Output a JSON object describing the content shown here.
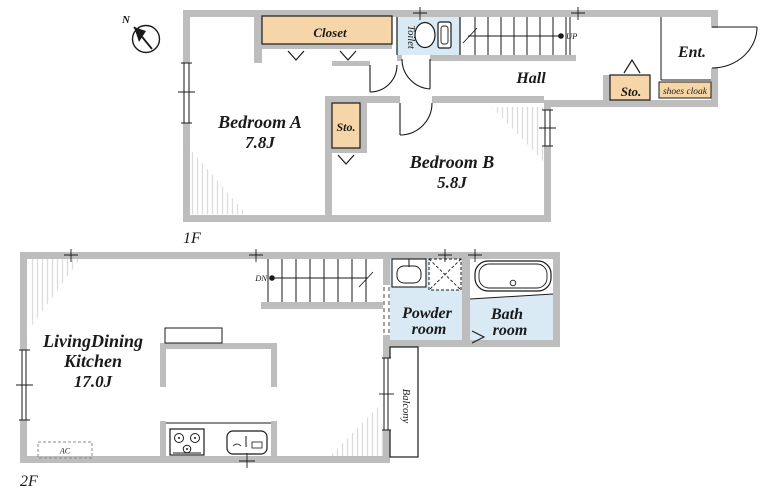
{
  "compass": {
    "north_label": "N"
  },
  "floor1": {
    "label": "1F",
    "bedroom_a": {
      "name": "Bedroom A",
      "size": "7.8J"
    },
    "bedroom_b": {
      "name": "Bedroom B",
      "size": "5.8J"
    },
    "closet": {
      "name": "Closet"
    },
    "toilet": {
      "name": "Toilet"
    },
    "hall": {
      "name": "Hall"
    },
    "entrance": {
      "name": "Ent."
    },
    "storage_hall": {
      "name": "Sto."
    },
    "storage_bedroom": {
      "name": "Sto."
    },
    "shoes_cloak": {
      "name": "shoes cloak"
    },
    "stairs": {
      "direction_label": "UP"
    }
  },
  "floor2": {
    "label": "2F",
    "ldk": {
      "name_line1": "LivingDining",
      "name_line2": "Kitchen",
      "size": "17.0J"
    },
    "powder_room": {
      "name_line1": "Powder",
      "name_line2": "room"
    },
    "bath_room": {
      "name_line1": "Bath",
      "name_line2": "room"
    },
    "balcony": {
      "name": "Balcony"
    },
    "stairs": {
      "direction_label": "DN"
    },
    "air_conditioner": {
      "label": "AC"
    }
  },
  "colors": {
    "wall": "#bdbdbd",
    "storage_fill": "#f6d6a8",
    "wet_area_fill": "#d9eaf4",
    "hatch": "#dcdcdc",
    "line": "#1a1a1a"
  }
}
